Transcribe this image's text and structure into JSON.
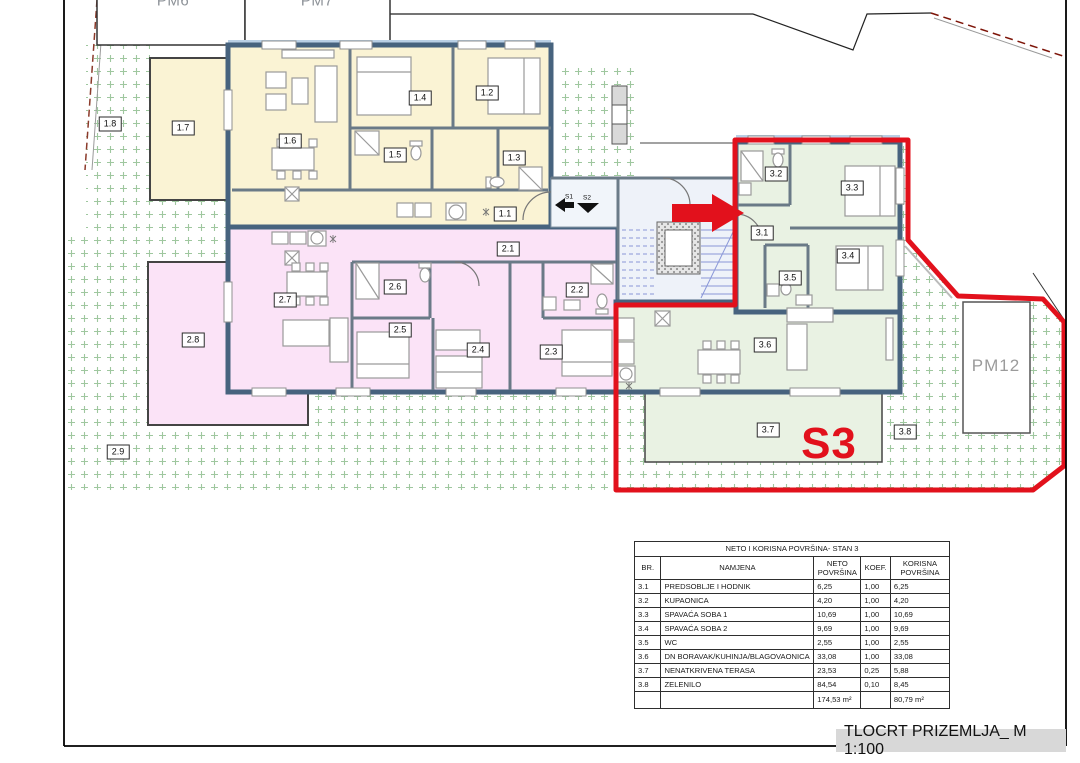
{
  "footer": {
    "title": "TLOCRT PRIZEMLJA_ M 1:100"
  },
  "parking": {
    "pm6": "PM6",
    "pm7": "PM7",
    "pm12": "PM12"
  },
  "highlight": {
    "unit_label": "S3"
  },
  "entrance": {
    "s1": "S1",
    "s2": "S2"
  },
  "colors": {
    "highlight_red": "#e2111c",
    "unit1_floor": "#faf3d4",
    "unit2_floor": "#fbe3f7",
    "unit3_floor": "#e9f2e3",
    "wall": "#47637e",
    "garden_mark": "#9fc79f",
    "stair_blue": "#8a97d8",
    "title_bg": "#d8d8d8"
  },
  "plan": {
    "room_labels": [
      {
        "id": "1.1",
        "x": 505,
        "y": 214
      },
      {
        "id": "1.2",
        "x": 487,
        "y": 93
      },
      {
        "id": "1.3",
        "x": 514,
        "y": 158
      },
      {
        "id": "1.4",
        "x": 420,
        "y": 98
      },
      {
        "id": "1.5",
        "x": 395,
        "y": 155
      },
      {
        "id": "1.6",
        "x": 290,
        "y": 141
      },
      {
        "id": "1.7",
        "x": 183,
        "y": 128
      },
      {
        "id": "1.8",
        "x": 110,
        "y": 124
      },
      {
        "id": "2.1",
        "x": 508,
        "y": 249
      },
      {
        "id": "2.2",
        "x": 577,
        "y": 290
      },
      {
        "id": "2.3",
        "x": 551,
        "y": 352
      },
      {
        "id": "2.4",
        "x": 478,
        "y": 350
      },
      {
        "id": "2.5",
        "x": 400,
        "y": 330
      },
      {
        "id": "2.6",
        "x": 395,
        "y": 287
      },
      {
        "id": "2.7",
        "x": 285,
        "y": 300
      },
      {
        "id": "2.8",
        "x": 193,
        "y": 340
      },
      {
        "id": "2.9",
        "x": 118,
        "y": 452
      },
      {
        "id": "3.1",
        "x": 762,
        "y": 233
      },
      {
        "id": "3.2",
        "x": 776,
        "y": 174
      },
      {
        "id": "3.3",
        "x": 852,
        "y": 188
      },
      {
        "id": "3.4",
        "x": 848,
        "y": 256
      },
      {
        "id": "3.5",
        "x": 790,
        "y": 278
      },
      {
        "id": "3.6",
        "x": 765,
        "y": 345
      },
      {
        "id": "3.7",
        "x": 768,
        "y": 430
      },
      {
        "id": "3.8",
        "x": 905,
        "y": 432
      }
    ]
  },
  "table": {
    "title": "NETO I KORISNA POVRŠINA- STAN 3",
    "headers": [
      "BR.",
      "NAMJENA",
      "NETO POVRŠINA",
      "KOEF.",
      "KORISNA POVRŠINA"
    ],
    "rows": [
      {
        "br": "3.1",
        "name": "PREDSOBLJE I HODNIK",
        "neto": "6,25",
        "koef": "1,00",
        "korisna": "6,25"
      },
      {
        "br": "3.2",
        "name": "KUPAONICA",
        "neto": "4,20",
        "koef": "1,00",
        "korisna": "4,20"
      },
      {
        "br": "3.3",
        "name": "SPAVAĆA SOBA 1",
        "neto": "10,69",
        "koef": "1,00",
        "korisna": "10,69"
      },
      {
        "br": "3.4",
        "name": "SPAVAĆA SOBA 2",
        "neto": "9,69",
        "koef": "1,00",
        "korisna": "9,69"
      },
      {
        "br": "3.5",
        "name": "WC",
        "neto": "2,55",
        "koef": "1,00",
        "korisna": "2,55"
      },
      {
        "br": "3.6",
        "name": "DN BORAVAK/KUHINJA/BLAGOVAONICA",
        "neto": "33,08",
        "koef": "1,00",
        "korisna": "33,08"
      },
      {
        "br": "3.7",
        "name": "NENATKRIVENA TERASA",
        "neto": "23,53",
        "koef": "0,25",
        "korisna": "5,88"
      },
      {
        "br": "3.8",
        "name": "ZELENILO",
        "neto": "84,54",
        "koef": "0,10",
        "korisna": "8,45"
      }
    ],
    "totals": {
      "neto": "174,53 m²",
      "korisna": "80,79 m²"
    }
  }
}
